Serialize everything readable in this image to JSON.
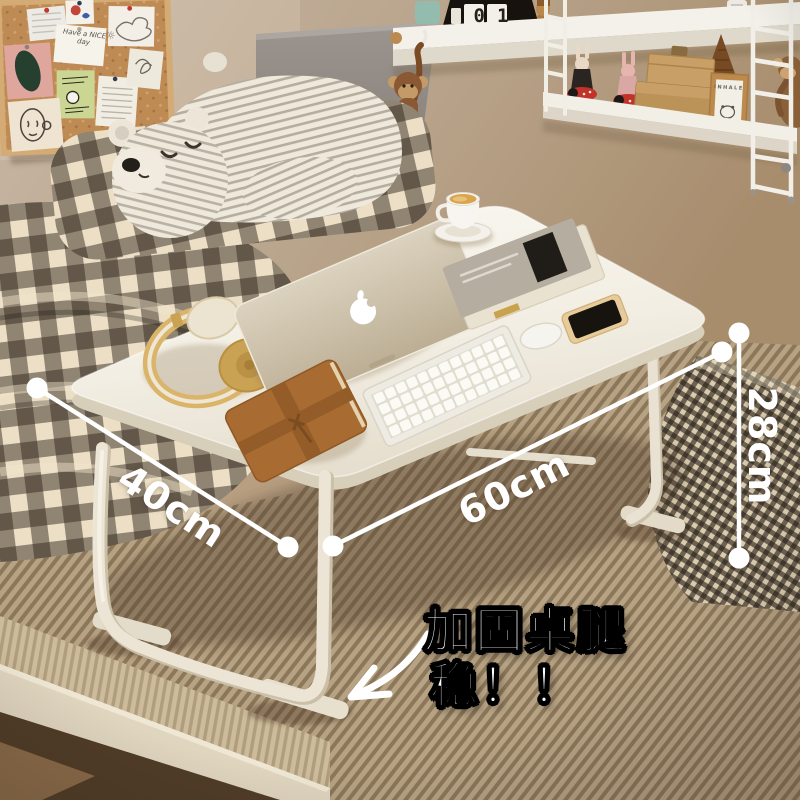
{
  "meta": {
    "description": "E-commerce product photo: foldable white bed lap desk on a bed, with dimension callouts"
  },
  "annotations": {
    "depth_label": "40cm",
    "width_label": "60cm",
    "height_label": "28cm",
    "callout_line1": "加固桌腿",
    "callout_line2": "稳！！"
  },
  "corkboard": {
    "note_text": "Have a NICE day",
    "sun_icon": "☼"
  },
  "shelf": {
    "calendar_value": "01",
    "frame_text": "INHALE"
  },
  "colors": {
    "annotation_white": "#ffffff",
    "callout_outline": "#000000",
    "wall_tan": "#b89f82",
    "headboard_grey": "#928b85",
    "table_white": "#f6f3ec",
    "leg_cream": "#e9e1d0",
    "blanket_tan": "#b7a283",
    "gingham_dark": "#3b3229",
    "slipper_red": "#c0322a",
    "journal_leather": "#a86c32",
    "headphone_gold": "#cfa65a",
    "latte": "#d9a54e"
  }
}
